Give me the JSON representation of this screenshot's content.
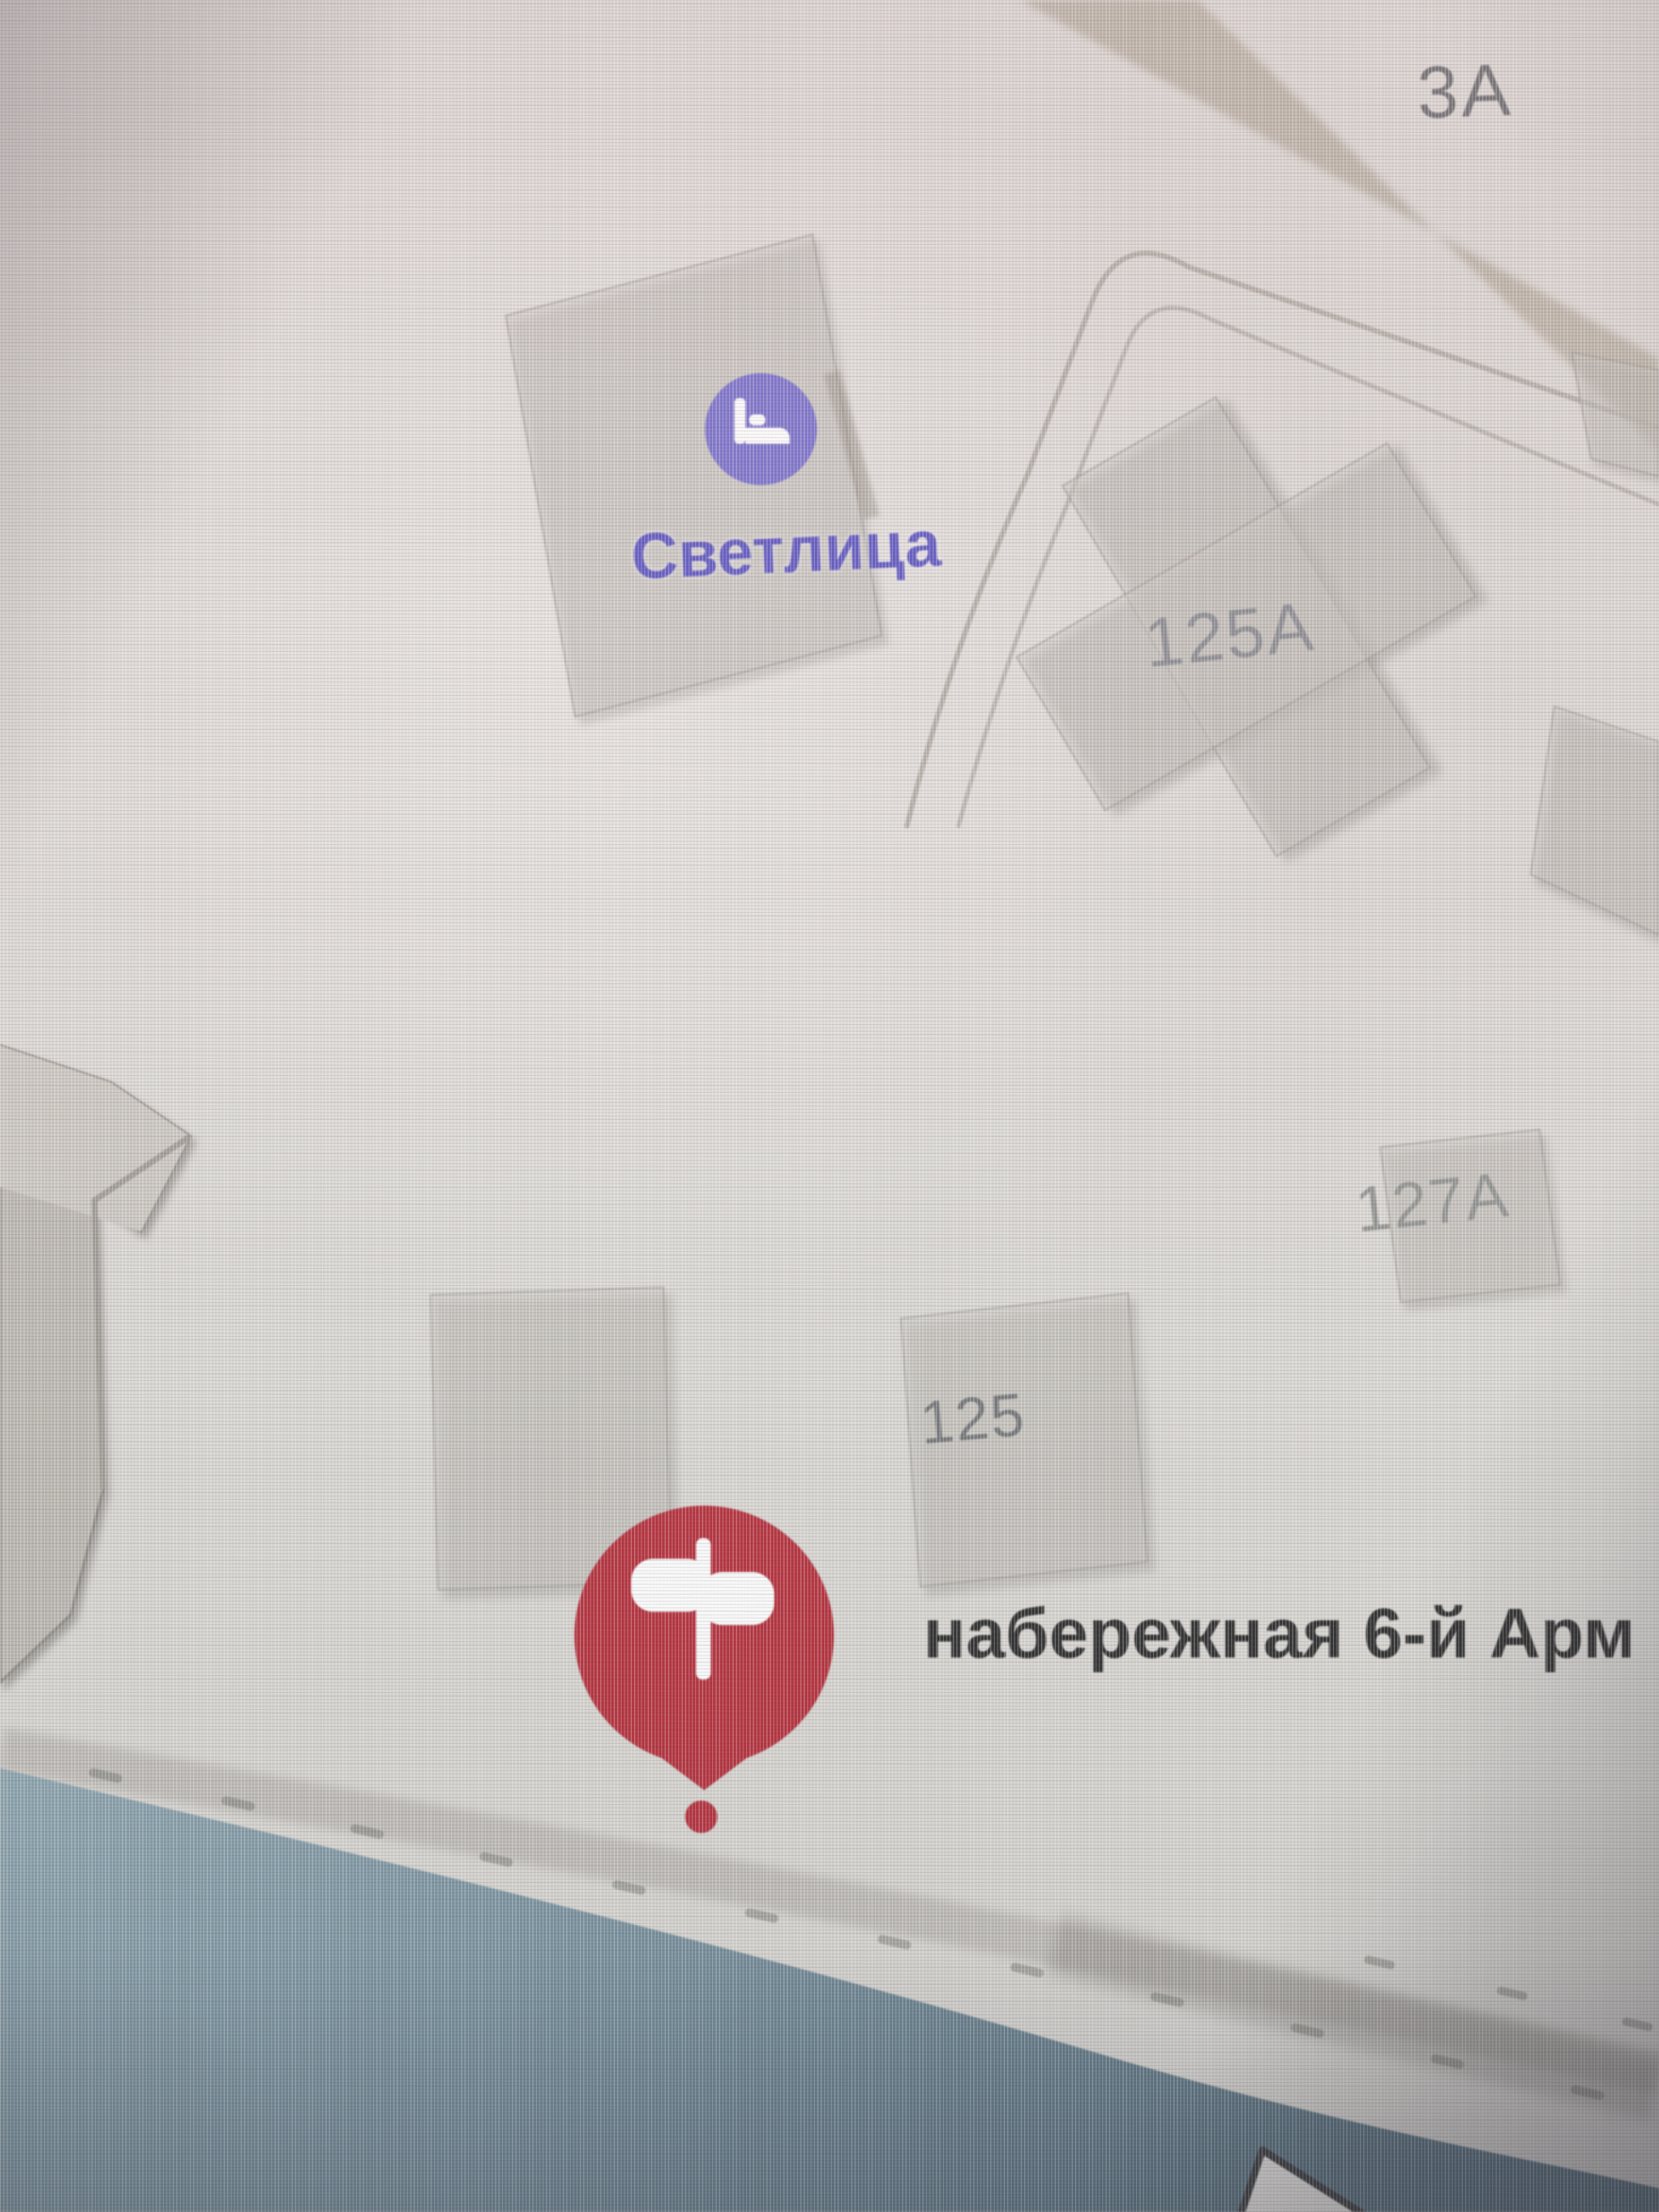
{
  "map": {
    "labels": {
      "building_3a": "3А",
      "building_125a": "125А",
      "building_127a": "127А",
      "building_125": "125",
      "street": "набережная 6-й Арм",
      "poi": "Светлица"
    },
    "colors": {
      "land": "#d8d5d0",
      "water_light": "#86a0ab",
      "water_mid": "#6d8896",
      "water_dark": "#4e6877",
      "building_fill": "#cfccc5",
      "building_edge": "#9a968f",
      "road_beige": "#b1a899",
      "shore_road": "#9a958e",
      "poi_purple": "#6e65cb",
      "poi_label": "#5750bf",
      "marker_red": "#b2212e",
      "street_text": "#1e1e1e",
      "cursor_fill": "#e9e7e3",
      "cursor_edge": "#303032"
    },
    "icons": {
      "poi": "hotel-bed-icon",
      "marker": "signpost-icon",
      "cursor": "mouse-pointer-icon"
    }
  }
}
